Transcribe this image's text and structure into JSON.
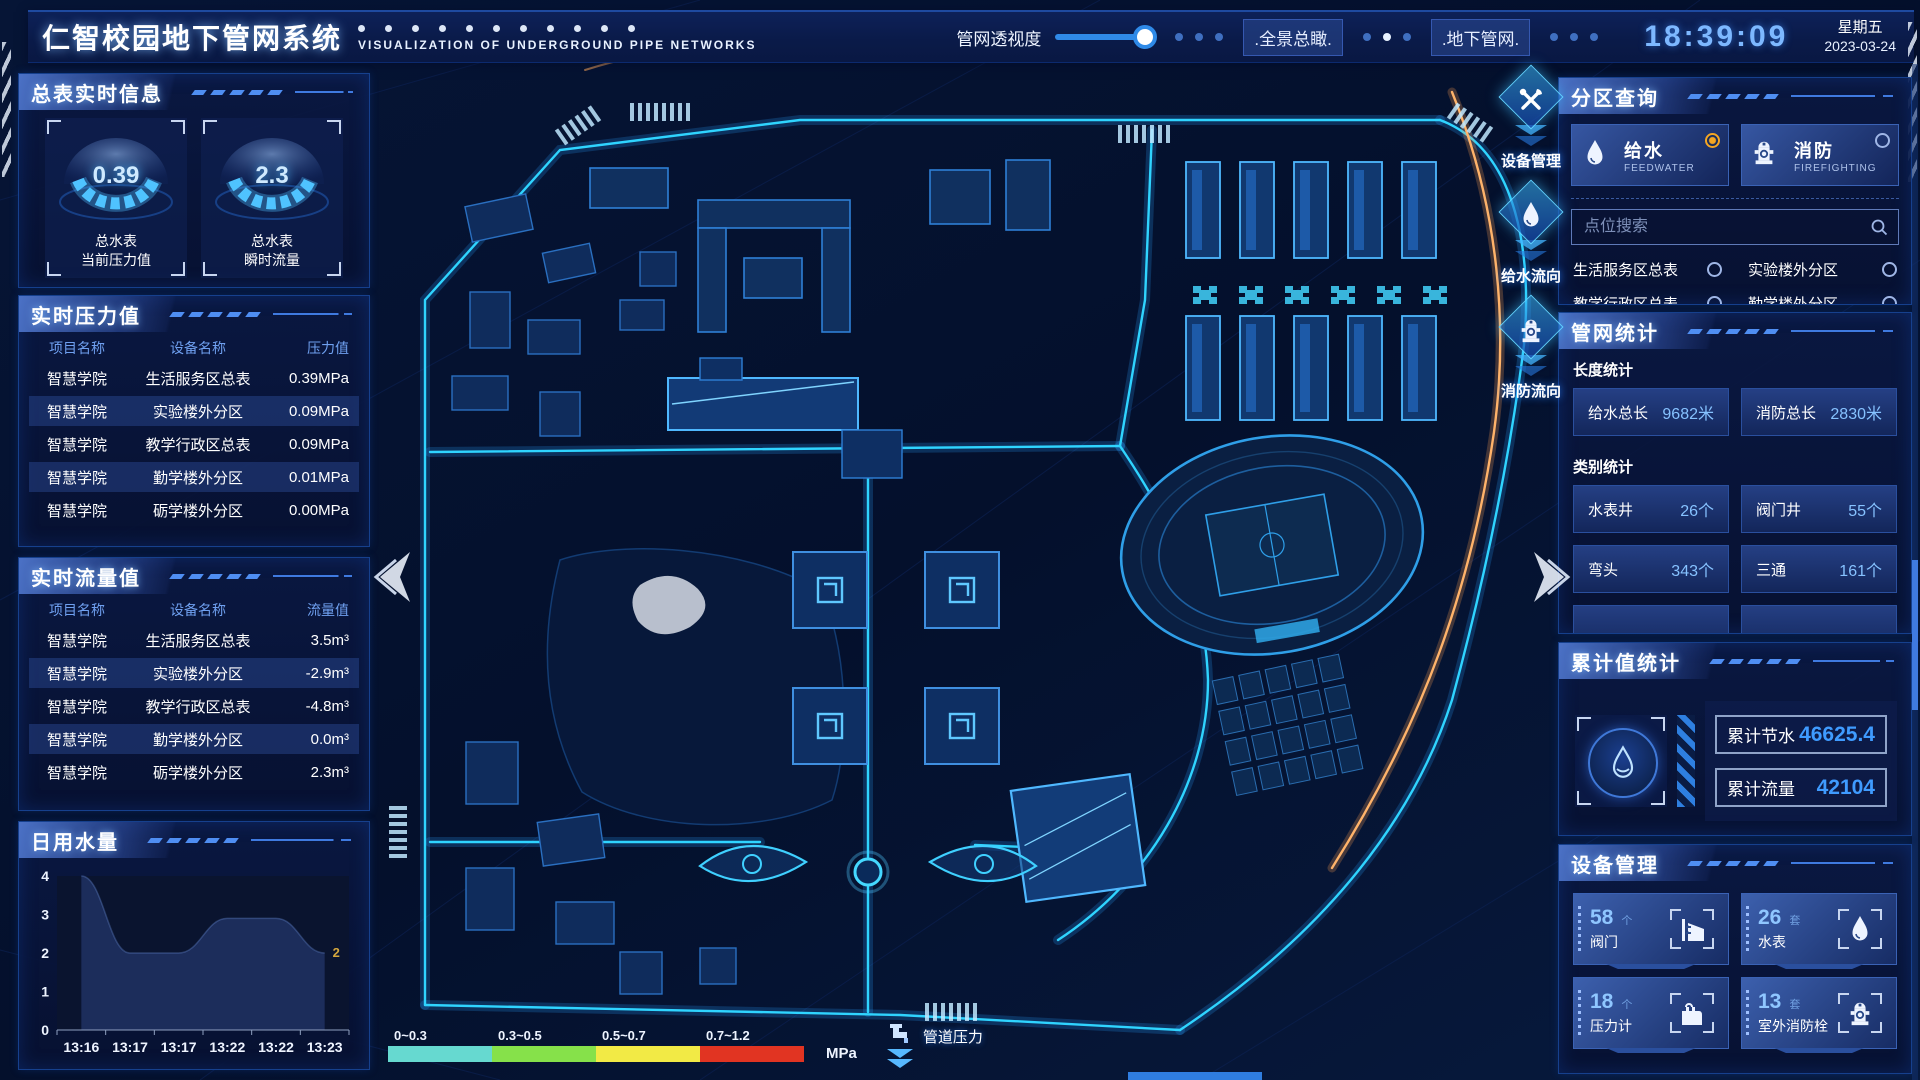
{
  "header": {
    "title": "仁智校园地下管网系统",
    "subtitle": "VISUALIZATION OF UNDERGROUND PIPE NETWORKS",
    "transparency": {
      "label": "管网透视度",
      "value_pct": 85
    },
    "overview_btn": ".全景总瞰.",
    "underground_btn": ".地下管网.",
    "time": "18:39:09",
    "weekday": "星期五",
    "date": "2023-03-24"
  },
  "left": {
    "realtime_info": {
      "title": "总表实时信息",
      "gauges": [
        {
          "value": "0.39",
          "label1": "总水表",
          "label2": "当前压力值"
        },
        {
          "value": "2.3",
          "label1": "总水表",
          "label2": "瞬时流量"
        }
      ]
    },
    "pressure": {
      "title": "实时压力值",
      "headers": [
        "项目名称",
        "设备名称",
        "压力值"
      ],
      "rows": [
        [
          "智慧学院",
          "生活服务区总表",
          "0.39MPa"
        ],
        [
          "智慧学院",
          "实验楼外分区",
          "0.09MPa"
        ],
        [
          "智慧学院",
          "教学行政区总表",
          "0.09MPa"
        ],
        [
          "智慧学院",
          "勤学楼外分区",
          "0.01MPa"
        ],
        [
          "智慧学院",
          "砺学楼外分区",
          "0.00MPa"
        ]
      ]
    },
    "flow": {
      "title": "实时流量值",
      "headers": [
        "项目名称",
        "设备名称",
        "流量值"
      ],
      "rows": [
        [
          "智慧学院",
          "生活服务区总表",
          "3.5m³"
        ],
        [
          "智慧学院",
          "实验楼外分区",
          "-2.9m³"
        ],
        [
          "智慧学院",
          "教学行政区总表",
          "-4.8m³"
        ],
        [
          "智慧学院",
          "勤学楼外分区",
          "0.0m³"
        ],
        [
          "智慧学院",
          "砺学楼外分区",
          "2.3m³"
        ]
      ]
    },
    "daily_water_title": "日用水量"
  },
  "chart_data": {
    "type": "area",
    "title": "日用水量",
    "x": [
      "13:16",
      "13:17",
      "13:17",
      "13:22",
      "13:22",
      "13:23"
    ],
    "values": [
      4,
      2,
      2,
      2.9,
      2.9,
      2
    ],
    "ylim": [
      0,
      4
    ],
    "yticks": [
      0,
      1,
      2,
      3,
      4
    ],
    "end_label": "2",
    "grid": false,
    "area_color": "#1e3060",
    "end_label_color": "#d4a73e"
  },
  "right": {
    "zone_query": {
      "title": "分区查询",
      "tabs": [
        {
          "label": "给水",
          "sub": "FEEDWATER",
          "icon": "water-drop-icon",
          "selected": true
        },
        {
          "label": "消防",
          "sub": "FIREFIGHTING",
          "icon": "hydrant-icon",
          "selected": false
        }
      ],
      "search_placeholder": "点位搜索",
      "items": [
        "生活服务区总表",
        "实验楼外分区",
        "教学行政区总表",
        "勤学楼外分区",
        "砺学楼外分区",
        "宿舍区泵房"
      ]
    },
    "pipe_stats": {
      "title": "管网统计",
      "length_label": "长度统计",
      "length_stats": [
        {
          "name": "给水总长",
          "value": "9682米"
        },
        {
          "name": "消防总长",
          "value": "2830米"
        }
      ],
      "category_label": "类别统计",
      "category_stats": [
        {
          "name": "水表井",
          "value": "26个"
        },
        {
          "name": "阀门井",
          "value": "55个"
        },
        {
          "name": "弯头",
          "value": "343个"
        },
        {
          "name": "三通",
          "value": "161个"
        }
      ]
    },
    "cumulative": {
      "title": "累计值统计",
      "icon": "water-drop-icon",
      "rows": [
        {
          "name": "累计节水",
          "value": "46625.4"
        },
        {
          "name": "累计流量",
          "value": "42104"
        }
      ]
    },
    "devices": {
      "title": "设备管理",
      "cards": [
        {
          "count": "58",
          "unit": "个",
          "name": "阀门",
          "icon": "valve-icon"
        },
        {
          "count": "26",
          "unit": "套",
          "name": "水表",
          "icon": "water-drop-icon"
        },
        {
          "count": "18",
          "unit": "个",
          "name": "压力计",
          "icon": "pressure-gauge-icon"
        },
        {
          "count": "13",
          "unit": "套",
          "name": "室外消防栓",
          "icon": "hydrant-icon"
        }
      ]
    }
  },
  "map": {
    "side_buttons": [
      {
        "label": "设备管理",
        "icon": "tools-icon"
      },
      {
        "label": "给水流向",
        "icon": "water-drop-icon"
      },
      {
        "label": "消防流向",
        "icon": "hydrant-icon"
      }
    ],
    "legend": {
      "ranges": [
        {
          "label": "0~0.3",
          "color": "#66d9d0"
        },
        {
          "label": "0.3~0.5",
          "color": "#86e14a"
        },
        {
          "label": "0.5~0.7",
          "color": "#f2ea45"
        },
        {
          "label": "0.7~1.2",
          "color": "#e13422"
        }
      ],
      "unit": "MPa",
      "pressure_label": "管道压力",
      "pipe_icon": "faucet-icon"
    }
  }
}
